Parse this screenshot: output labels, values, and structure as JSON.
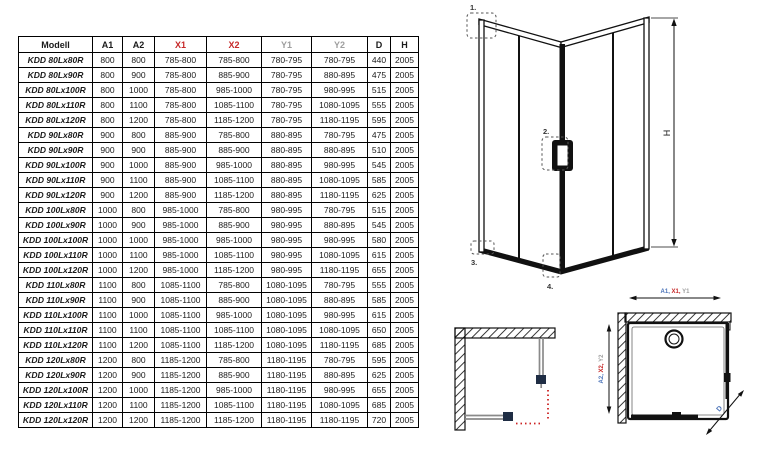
{
  "colors": {
    "black": "#1a1a1a",
    "red": "#c62828",
    "gray": "#9e9e9e",
    "blue": "#4a72b8",
    "arrow_red": "#cc2222",
    "panel_gray": "#8a8a8a",
    "handle_navy": "#1f2d44"
  },
  "table": {
    "headers": [
      {
        "label": "Modell",
        "color": "black",
        "model_col": true
      },
      {
        "label": "A1",
        "color": "black"
      },
      {
        "label": "A2",
        "color": "black"
      },
      {
        "label": "X1",
        "color": "red"
      },
      {
        "label": "X2",
        "color": "red"
      },
      {
        "label": "Y1",
        "color": "gray"
      },
      {
        "label": "Y2",
        "color": "gray"
      },
      {
        "label": "D",
        "color": "black"
      },
      {
        "label": "H",
        "color": "black"
      }
    ],
    "rows": [
      [
        "KDD 80Lx80R",
        "800",
        "800",
        "785-800",
        "785-800",
        "780-795",
        "780-795",
        "440",
        "2005"
      ],
      [
        "KDD 80Lx90R",
        "800",
        "900",
        "785-800",
        "885-900",
        "780-795",
        "880-895",
        "475",
        "2005"
      ],
      [
        "KDD 80Lx100R",
        "800",
        "1000",
        "785-800",
        "985-1000",
        "780-795",
        "980-995",
        "515",
        "2005"
      ],
      [
        "KDD 80Lx110R",
        "800",
        "1100",
        "785-800",
        "1085-1100",
        "780-795",
        "1080-1095",
        "555",
        "2005"
      ],
      [
        "KDD 80Lx120R",
        "800",
        "1200",
        "785-800",
        "1185-1200",
        "780-795",
        "1180-1195",
        "595",
        "2005"
      ],
      [
        "KDD 90Lx80R",
        "900",
        "800",
        "885-900",
        "785-800",
        "880-895",
        "780-795",
        "475",
        "2005"
      ],
      [
        "KDD 90Lx90R",
        "900",
        "900",
        "885-900",
        "885-900",
        "880-895",
        "880-895",
        "510",
        "2005"
      ],
      [
        "KDD 90Lx100R",
        "900",
        "1000",
        "885-900",
        "985-1000",
        "880-895",
        "980-995",
        "545",
        "2005"
      ],
      [
        "KDD 90Lx110R",
        "900",
        "1100",
        "885-900",
        "1085-1100",
        "880-895",
        "1080-1095",
        "585",
        "2005"
      ],
      [
        "KDD 90Lx120R",
        "900",
        "1200",
        "885-900",
        "1185-1200",
        "880-895",
        "1180-1195",
        "625",
        "2005"
      ],
      [
        "KDD 100Lx80R",
        "1000",
        "800",
        "985-1000",
        "785-800",
        "980-995",
        "780-795",
        "515",
        "2005"
      ],
      [
        "KDD 100Lx90R",
        "1000",
        "900",
        "985-1000",
        "885-900",
        "980-995",
        "880-895",
        "545",
        "2005"
      ],
      [
        "KDD 100Lx100R",
        "1000",
        "1000",
        "985-1000",
        "985-1000",
        "980-995",
        "980-995",
        "580",
        "2005"
      ],
      [
        "KDD 100Lx110R",
        "1000",
        "1100",
        "985-1000",
        "1085-1100",
        "980-995",
        "1080-1095",
        "615",
        "2005"
      ],
      [
        "KDD 100Lx120R",
        "1000",
        "1200",
        "985-1000",
        "1185-1200",
        "980-995",
        "1180-1195",
        "655",
        "2005"
      ],
      [
        "KDD 110Lx80R",
        "1100",
        "800",
        "1085-1100",
        "785-800",
        "1080-1095",
        "780-795",
        "555",
        "2005"
      ],
      [
        "KDD 110Lx90R",
        "1100",
        "900",
        "1085-1100",
        "885-900",
        "1080-1095",
        "880-895",
        "585",
        "2005"
      ],
      [
        "KDD 110Lx100R",
        "1100",
        "1000",
        "1085-1100",
        "985-1000",
        "1080-1095",
        "980-995",
        "615",
        "2005"
      ],
      [
        "KDD 110Lx110R",
        "1100",
        "1100",
        "1085-1100",
        "1085-1100",
        "1080-1095",
        "1080-1095",
        "650",
        "2005"
      ],
      [
        "KDD 110Lx120R",
        "1100",
        "1200",
        "1085-1100",
        "1185-1200",
        "1080-1095",
        "1180-1195",
        "685",
        "2005"
      ],
      [
        "KDD 120Lx80R",
        "1200",
        "800",
        "1185-1200",
        "785-800",
        "1180-1195",
        "780-795",
        "595",
        "2005"
      ],
      [
        "KDD 120Lx90R",
        "1200",
        "900",
        "1185-1200",
        "885-900",
        "1180-1195",
        "880-895",
        "625",
        "2005"
      ],
      [
        "KDD 120Lx100R",
        "1200",
        "1000",
        "1185-1200",
        "985-1000",
        "1180-1195",
        "980-995",
        "655",
        "2005"
      ],
      [
        "KDD 120Lx110R",
        "1200",
        "1100",
        "1185-1200",
        "1085-1100",
        "1180-1195",
        "1080-1095",
        "685",
        "2005"
      ],
      [
        "KDD 120Lx120R",
        "1200",
        "1200",
        "1185-1200",
        "1185-1200",
        "1180-1195",
        "1180-1195",
        "720",
        "2005"
      ]
    ]
  },
  "diagrams": {
    "iso": {
      "callout_1": "1.",
      "callout_2": "2.",
      "callout_3": "3.",
      "callout_4": "4.",
      "height_label": "H"
    },
    "plan_tray": {
      "h_label_parts": [
        {
          "text": "A1,",
          "color": "blue"
        },
        {
          "text": " X1,",
          "color": "red"
        },
        {
          "text": " Y1",
          "color": "gray"
        }
      ],
      "v_label_parts": [
        {
          "text": "A2,",
          "color": "blue"
        },
        {
          "text": " X2,",
          "color": "red"
        },
        {
          "text": " Y2",
          "color": "gray"
        }
      ],
      "diagonal_label": "D"
    }
  }
}
